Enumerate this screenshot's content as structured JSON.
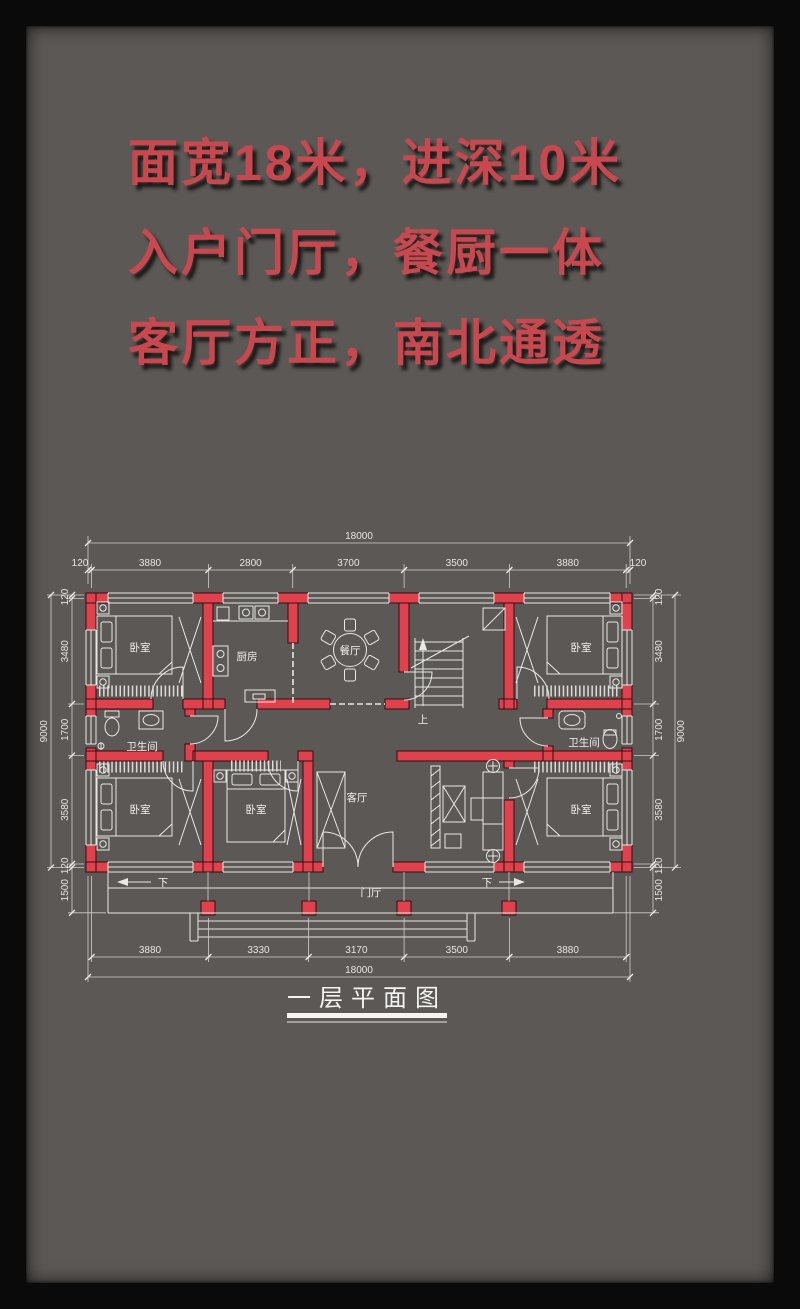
{
  "colors": {
    "background": "#5c5855",
    "frame": "#0a0a0a",
    "accent_red": "#c7484f",
    "wall_red": "#e0424d",
    "line_white": "#e9e8e5"
  },
  "tagline": {
    "line1": "面宽18米，进深10米",
    "line2": "入户门厅，餐厨一体",
    "line3": "客厅方正，南北通透"
  },
  "plan": {
    "title": "一层平面图",
    "rooms": {
      "bedroom": "卧室",
      "kitchen": "厨房",
      "dining": "餐厅",
      "living": "客厅",
      "bathroom": "卫生间",
      "foyer": "门厅",
      "stairs_up": "上",
      "steps_down": "下"
    },
    "dims": {
      "top_total": "18000",
      "top_segments": [
        "120",
        "3880",
        "2800",
        "3700",
        "3500",
        "3880",
        "120"
      ],
      "bottom_segments": [
        "3880",
        "3330",
        "3170",
        "3500",
        "3880"
      ],
      "bottom_total": "18000",
      "side_segments": [
        "120",
        "3480",
        "1700",
        "3580",
        "120",
        "1500"
      ],
      "side_total": "9000"
    }
  }
}
